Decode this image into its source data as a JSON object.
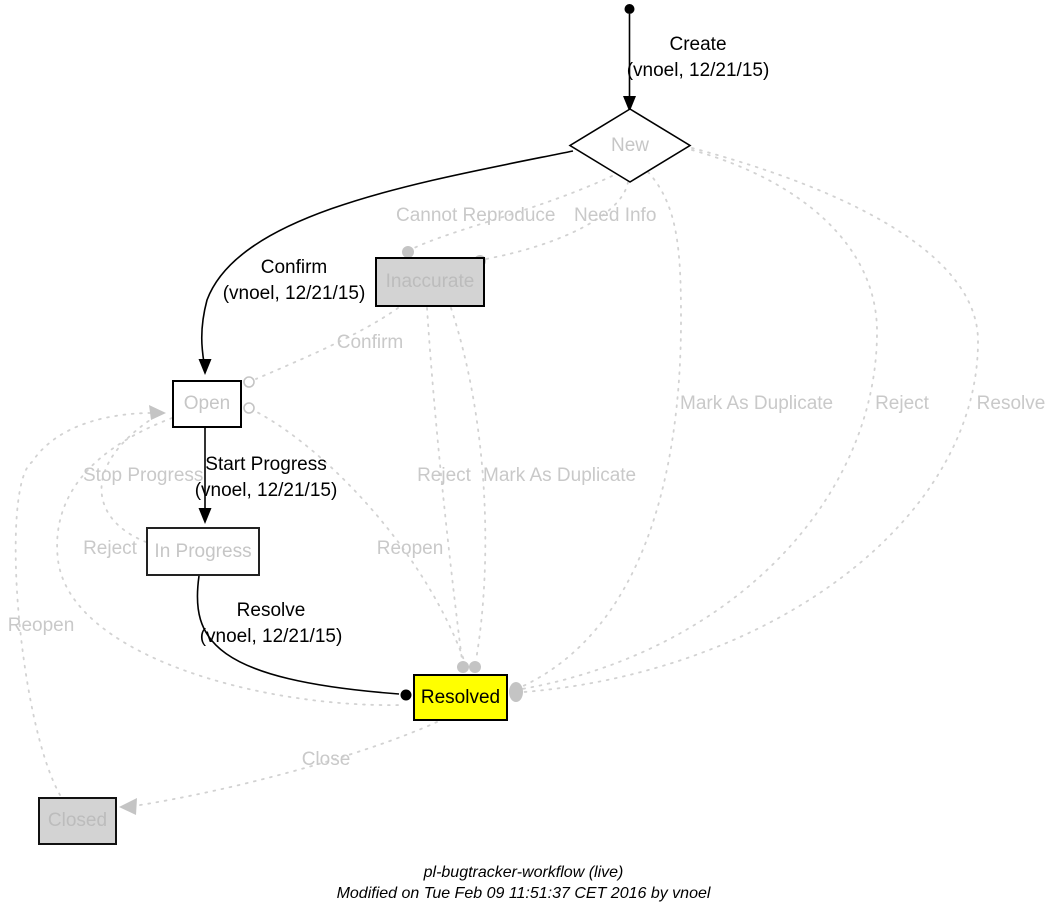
{
  "states": {
    "new": {
      "label": "New"
    },
    "inaccurate": {
      "label": "Inaccurate"
    },
    "open": {
      "label": "Open"
    },
    "in_progress": {
      "label": "In Progress"
    },
    "resolved": {
      "label": "Resolved"
    },
    "closed": {
      "label": "Closed"
    }
  },
  "transitions": {
    "create": {
      "label": "Create",
      "meta": "(vnoel, 12/21/15)",
      "status": "active"
    },
    "confirm": {
      "label": "Confirm",
      "meta": "(vnoel, 12/21/15)",
      "status": "active"
    },
    "start_progress": {
      "label": "Start Progress",
      "meta": "(vnoel, 12/21/15)",
      "status": "active"
    },
    "resolve": {
      "label": "Resolve",
      "meta": "(vnoel, 12/21/15)",
      "status": "active"
    },
    "cannot_reproduce": {
      "label": "Cannot Reproduce",
      "status": "inactive"
    },
    "need_info": {
      "label": "Need Info",
      "status": "inactive"
    },
    "confirm_inactive": {
      "label": "Confirm",
      "status": "inactive"
    },
    "mark_as_duplicate_new": {
      "label": "Mark As Duplicate",
      "status": "inactive"
    },
    "reject_new": {
      "label": "Reject",
      "status": "inactive"
    },
    "resolve_new": {
      "label": "Resolve",
      "status": "inactive"
    },
    "reject_inaccurate": {
      "label": "Reject",
      "status": "inactive"
    },
    "mark_as_duplicate_inaccurate": {
      "label": "Mark As Duplicate",
      "status": "inactive"
    },
    "stop_progress": {
      "label": "Stop Progress",
      "status": "inactive"
    },
    "reject_open": {
      "label": "Reject",
      "status": "inactive"
    },
    "reopen_resolved": {
      "label": "Reopen",
      "status": "inactive"
    },
    "reopen_closed": {
      "label": "Reopen",
      "status": "inactive"
    },
    "close": {
      "label": "Close",
      "status": "inactive"
    }
  },
  "footer": {
    "title": "pl-bugtracker-workflow (live)",
    "modified": "Modified on Tue Feb 09 11:51:37 CET 2016 by vnoel"
  },
  "colors": {
    "resolved_fill": "#ffff00",
    "disabled_state_fill": "#d3d3d3",
    "active_edge": "#000000",
    "inactive_edge": "#d2d2d2",
    "inactive_text": "#c9c9c9",
    "state_border": "#000000"
  }
}
